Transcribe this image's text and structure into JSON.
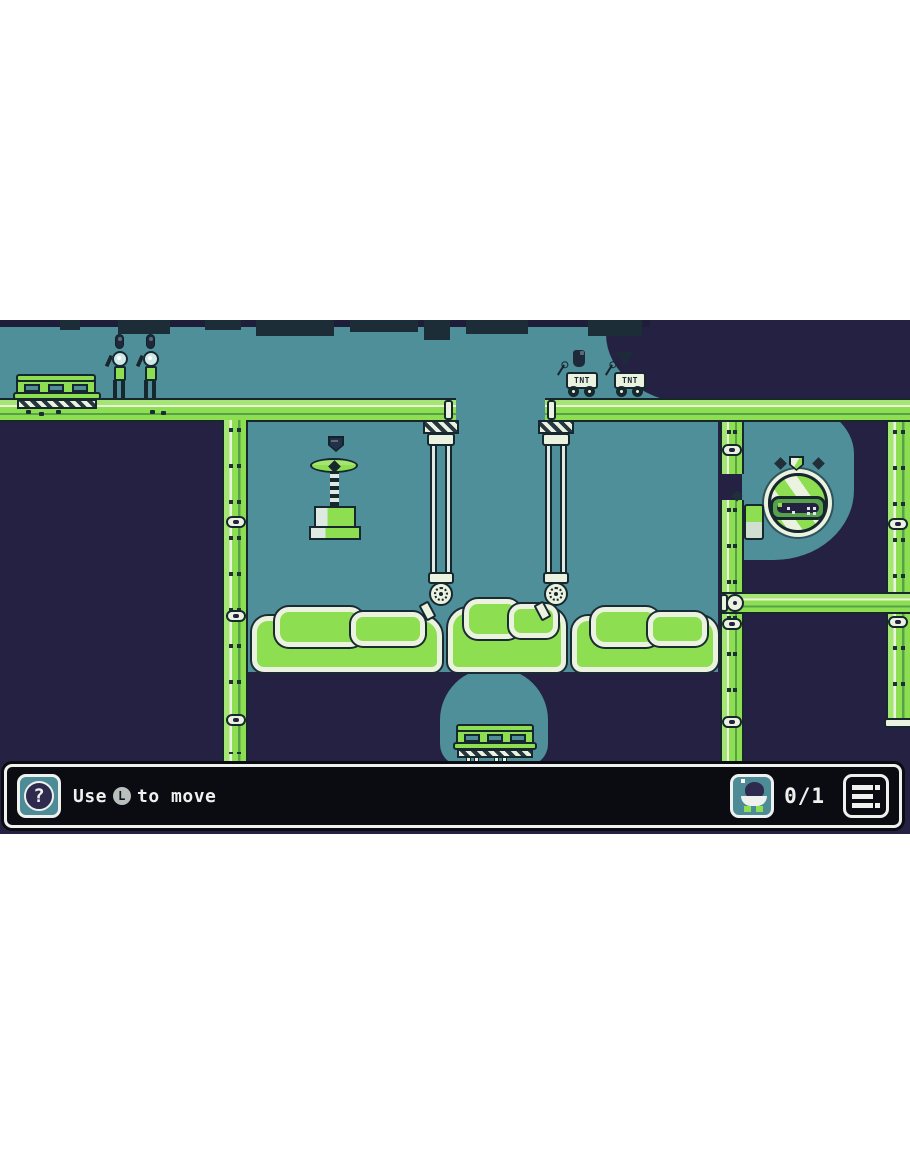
{
  "hud": {
    "help_button": {
      "icon": "question-icon",
      "glyph": "?"
    },
    "hint": {
      "prefix": "Use",
      "key_label": "L",
      "suffix": "to move"
    },
    "collectibles": {
      "icon": "creature-icon",
      "count": "0/1"
    },
    "menu_button": {
      "icon": "menu-list-icon"
    }
  },
  "world": {
    "tnt_carts": [
      {
        "label": "TNT"
      },
      {
        "label": "TNT"
      }
    ],
    "entities": [
      "robot",
      "robot",
      "tnt-cart",
      "tnt-cart",
      "propeller-crane-with-crate",
      "drill",
      "drill",
      "goo-blob",
      "goo-blob",
      "goo-blob",
      "escape-pod",
      "railing-platform",
      "railing-platform"
    ],
    "markers": [
      "pill-marker",
      "pill-marker",
      "flask-marker",
      "pennant-marker",
      "shield-marker-dark",
      "shield-marker-green",
      "diamond-dot",
      "diamond-dot",
      "diamond-dot"
    ]
  },
  "colors": {
    "background_navy": "#242143",
    "cave_teal": "#4f8f99",
    "girder_green": "#8ede52",
    "goo_green": "#8ede52",
    "outline_ink": "#16282e",
    "pale_cream": "#ebf2df",
    "hud_black": "#0b0b12",
    "hud_frame_white": "#eef1ee",
    "icon_teal": "#4d8c96",
    "page_white": "#ffffff"
  }
}
